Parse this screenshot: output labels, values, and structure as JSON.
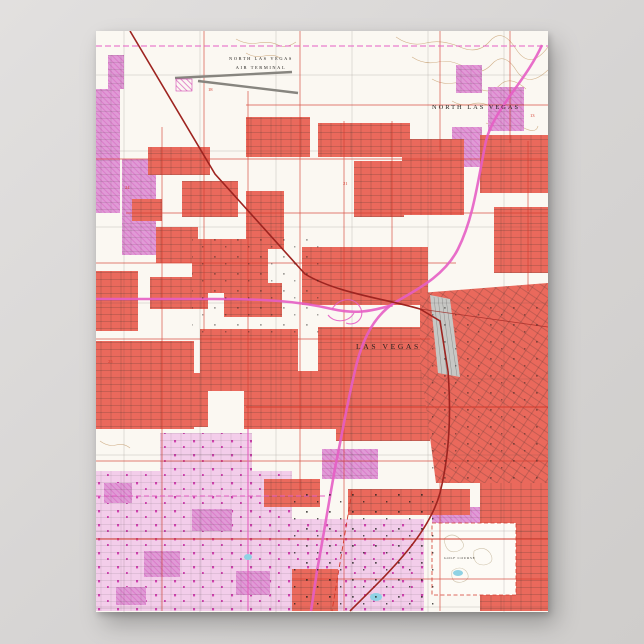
{
  "scene": {
    "background_color": "#d6d4d3",
    "background_color_light": "#e2e0df",
    "background_color_dark": "#cfcdcb"
  },
  "poster": {
    "kind": "vintage USGS topographic map poster of Las Vegas, Nevada"
  },
  "map": {
    "labels": {
      "airport_line1": "NORTH LAS VEGAS",
      "airport_line2": "AIR TERMINAL",
      "north_las_vegas": "NORTH LAS VEGAS",
      "las_vegas": "LAS VEGAS",
      "golf_course": "GOLF COURSE",
      "section_numbers": [
        "18",
        "24",
        "13",
        "21",
        "25"
      ]
    },
    "colors": {
      "paper": "#fbf8f2",
      "urban-red": "#ea695c",
      "urban-pink": "#e09ad6",
      "pink-light": "#f3cdea",
      "magenta": "#cb2aa6",
      "road-red": "#d23a2c",
      "railroad-red": "#9e2420",
      "highway-pink": "#e55ec4",
      "contour-tan": "#c79f70",
      "grid-black": "#2f2c28",
      "yard-grey": "#8f8f8d",
      "yard-fill": "#c7c7c4",
      "water-blue": "#8fd2e4"
    }
  }
}
